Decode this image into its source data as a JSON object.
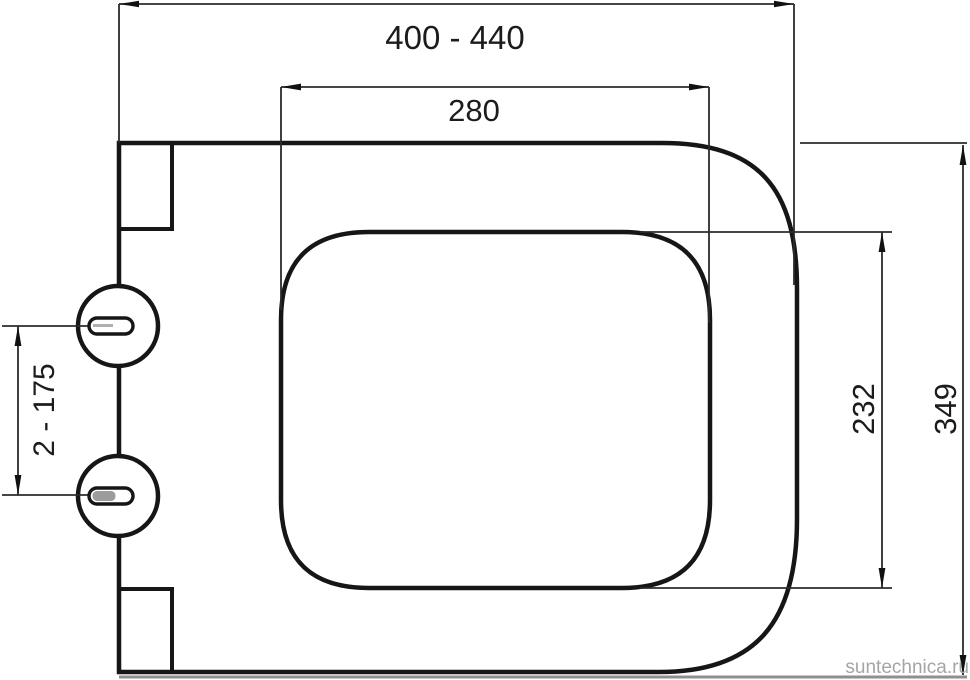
{
  "drawing": {
    "kind": "technical-dimension-drawing",
    "labels": {
      "overall_width": "400 - 440",
      "opening_width": "280",
      "hinge_spacing": "2 - 175",
      "opening_depth": "232",
      "overall_depth": "349"
    },
    "watermark": "suntechnica.ru",
    "colors": {
      "outline": "#161616",
      "dimension_line": "#2b2b2b",
      "text": "#1c1c1c",
      "watermark": "#a5a5a5",
      "slot_fill": "#9c9c9c",
      "shadow_line": "#8f8f8f",
      "background": "#ffffff"
    }
  }
}
